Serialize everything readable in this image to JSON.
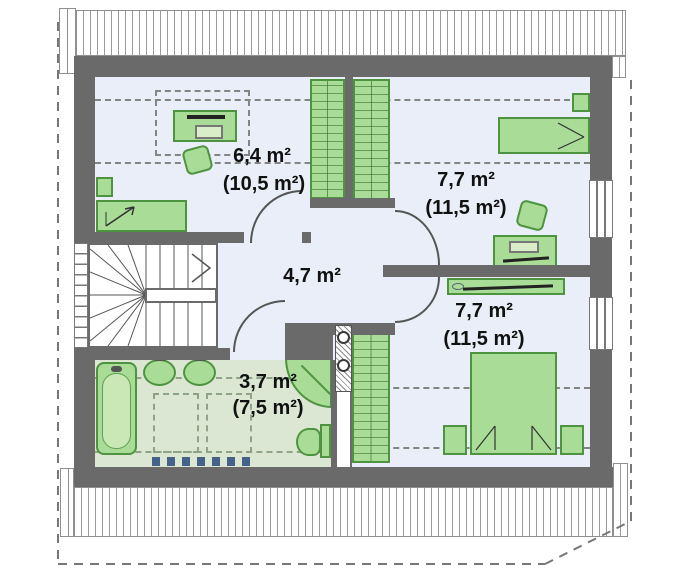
{
  "plan": {
    "type": "floor-plan",
    "floor": "attic",
    "rooms": [
      {
        "key": "bedroom-top-left",
        "area": "6,4 m²",
        "area_gross": "(10,5 m²)"
      },
      {
        "key": "bedroom-top-right",
        "area": "7,7 m²",
        "area_gross": "(11,5 m²)"
      },
      {
        "key": "hall",
        "area": "4,7 m²",
        "area_gross": ""
      },
      {
        "key": "bedroom-bottom-right",
        "area": "7,7 m²",
        "area_gross": "(11,5 m²)"
      },
      {
        "key": "bathroom",
        "area": "3,7 m²",
        "area_gross": "(7,5 m²)"
      }
    ],
    "fixtures": [
      "stairs",
      "bathtub",
      "washbasin",
      "washbasin",
      "shower",
      "toilet",
      "radiator",
      "chimney-flues",
      "bed",
      "double-bed",
      "wardrobe",
      "desk",
      "chair",
      "window",
      "door"
    ],
    "colors": {
      "wall": "#6a6a6a",
      "furniture": "#a9dc96",
      "furniture_border": "#4e9440",
      "floor": "#e9eef8",
      "bathroom_floor": "#dbe7d2",
      "radiator": "#44628a",
      "dashed_lines": "#848484"
    }
  }
}
